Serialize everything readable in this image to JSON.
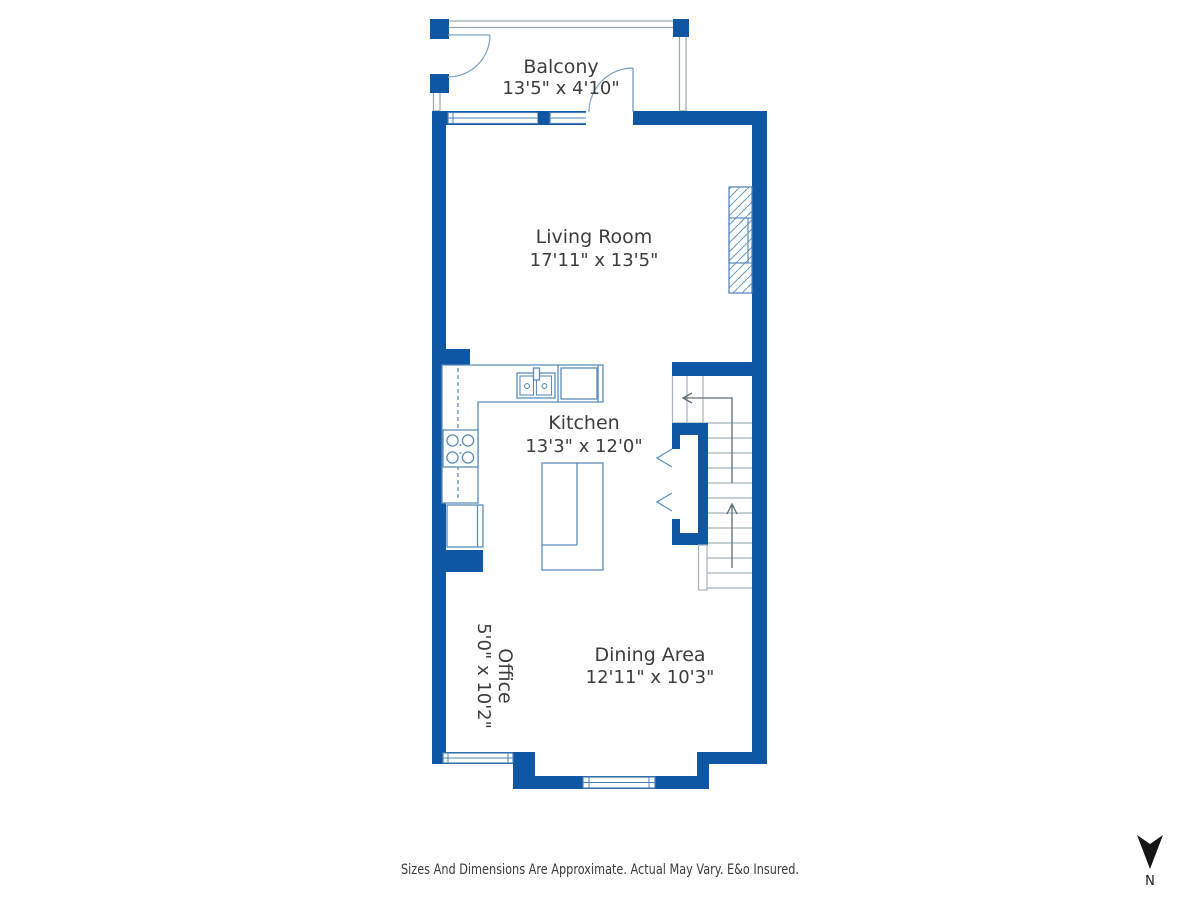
{
  "plan": {
    "rooms": [
      {
        "id": "balcony",
        "name": "Balcony",
        "dims": "13'5\" x 4'10\""
      },
      {
        "id": "living-room",
        "name": "Living Room",
        "dims": "17'11\" x 13'5\""
      },
      {
        "id": "kitchen",
        "name": "Kitchen",
        "dims": "13'3\" x 12'0\""
      },
      {
        "id": "office",
        "name": "Office",
        "dims": "5'0\" x 10'2\""
      },
      {
        "id": "dining-area",
        "name": "Dining Area",
        "dims": "12'11\" x 10'3\""
      }
    ]
  },
  "footer": {
    "disclaimer": "Sizes And Dimensions Are Approximate. Actual May Vary. E&o Insured."
  },
  "compass": {
    "label": "N"
  },
  "colors": {
    "wall": "#0f57a5",
    "fixture_line": "#5b8cba",
    "window_line": "#4a80b8",
    "rail_line": "#97a5ad",
    "stair_line": "#a3b2bb",
    "text": "#3c3c3c"
  }
}
